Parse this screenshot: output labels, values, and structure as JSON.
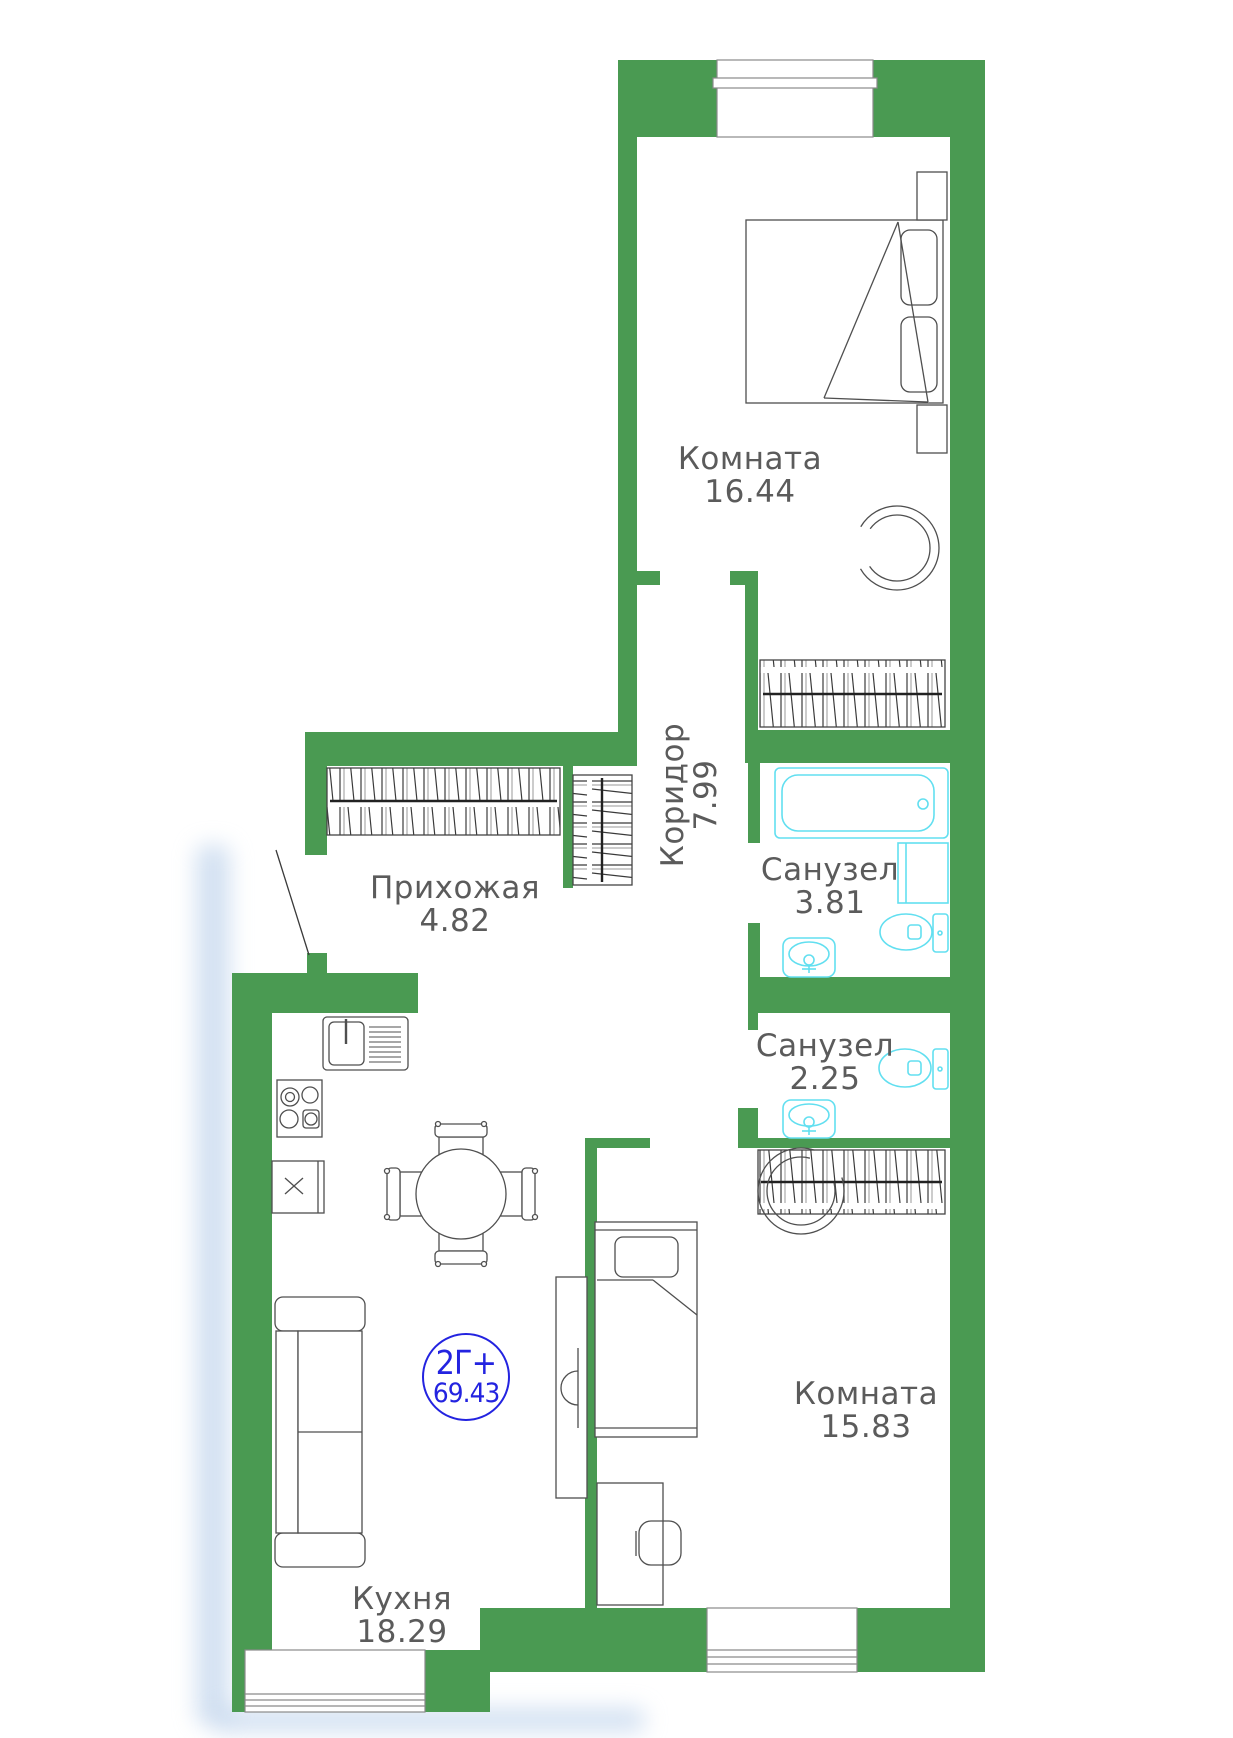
{
  "plan": {
    "title_badge": {
      "type": "2Г+",
      "area": "69.43"
    },
    "rooms": [
      {
        "name": "Комната",
        "area": "16.44"
      },
      {
        "name": "Коридор",
        "area": "7.99"
      },
      {
        "name": "Прихожая",
        "area": "4.82"
      },
      {
        "name": "Санузел",
        "area": "3.81"
      },
      {
        "name": "Санузел",
        "area": "2.25"
      },
      {
        "name": "Комната",
        "area": "15.83"
      },
      {
        "name": "Кухня",
        "area": "18.29"
      }
    ],
    "colors": {
      "wall_green": "#4a9a52",
      "sanitary_cyan": "#62dff0",
      "furniture_stroke": "#4f4f4f",
      "label_gray": "#5b5b5b",
      "badge_blue": "#2323e0"
    },
    "icons": [
      "double-bed",
      "nightstand",
      "armchair",
      "wardrobe-hangers",
      "bathtub",
      "washing-machine",
      "toilet",
      "sink",
      "stove",
      "kitchen-sink-counter",
      "fridge-cabinet",
      "dining-table",
      "chair",
      "sofa",
      "single-bed",
      "desk",
      "window",
      "door-swing"
    ]
  }
}
